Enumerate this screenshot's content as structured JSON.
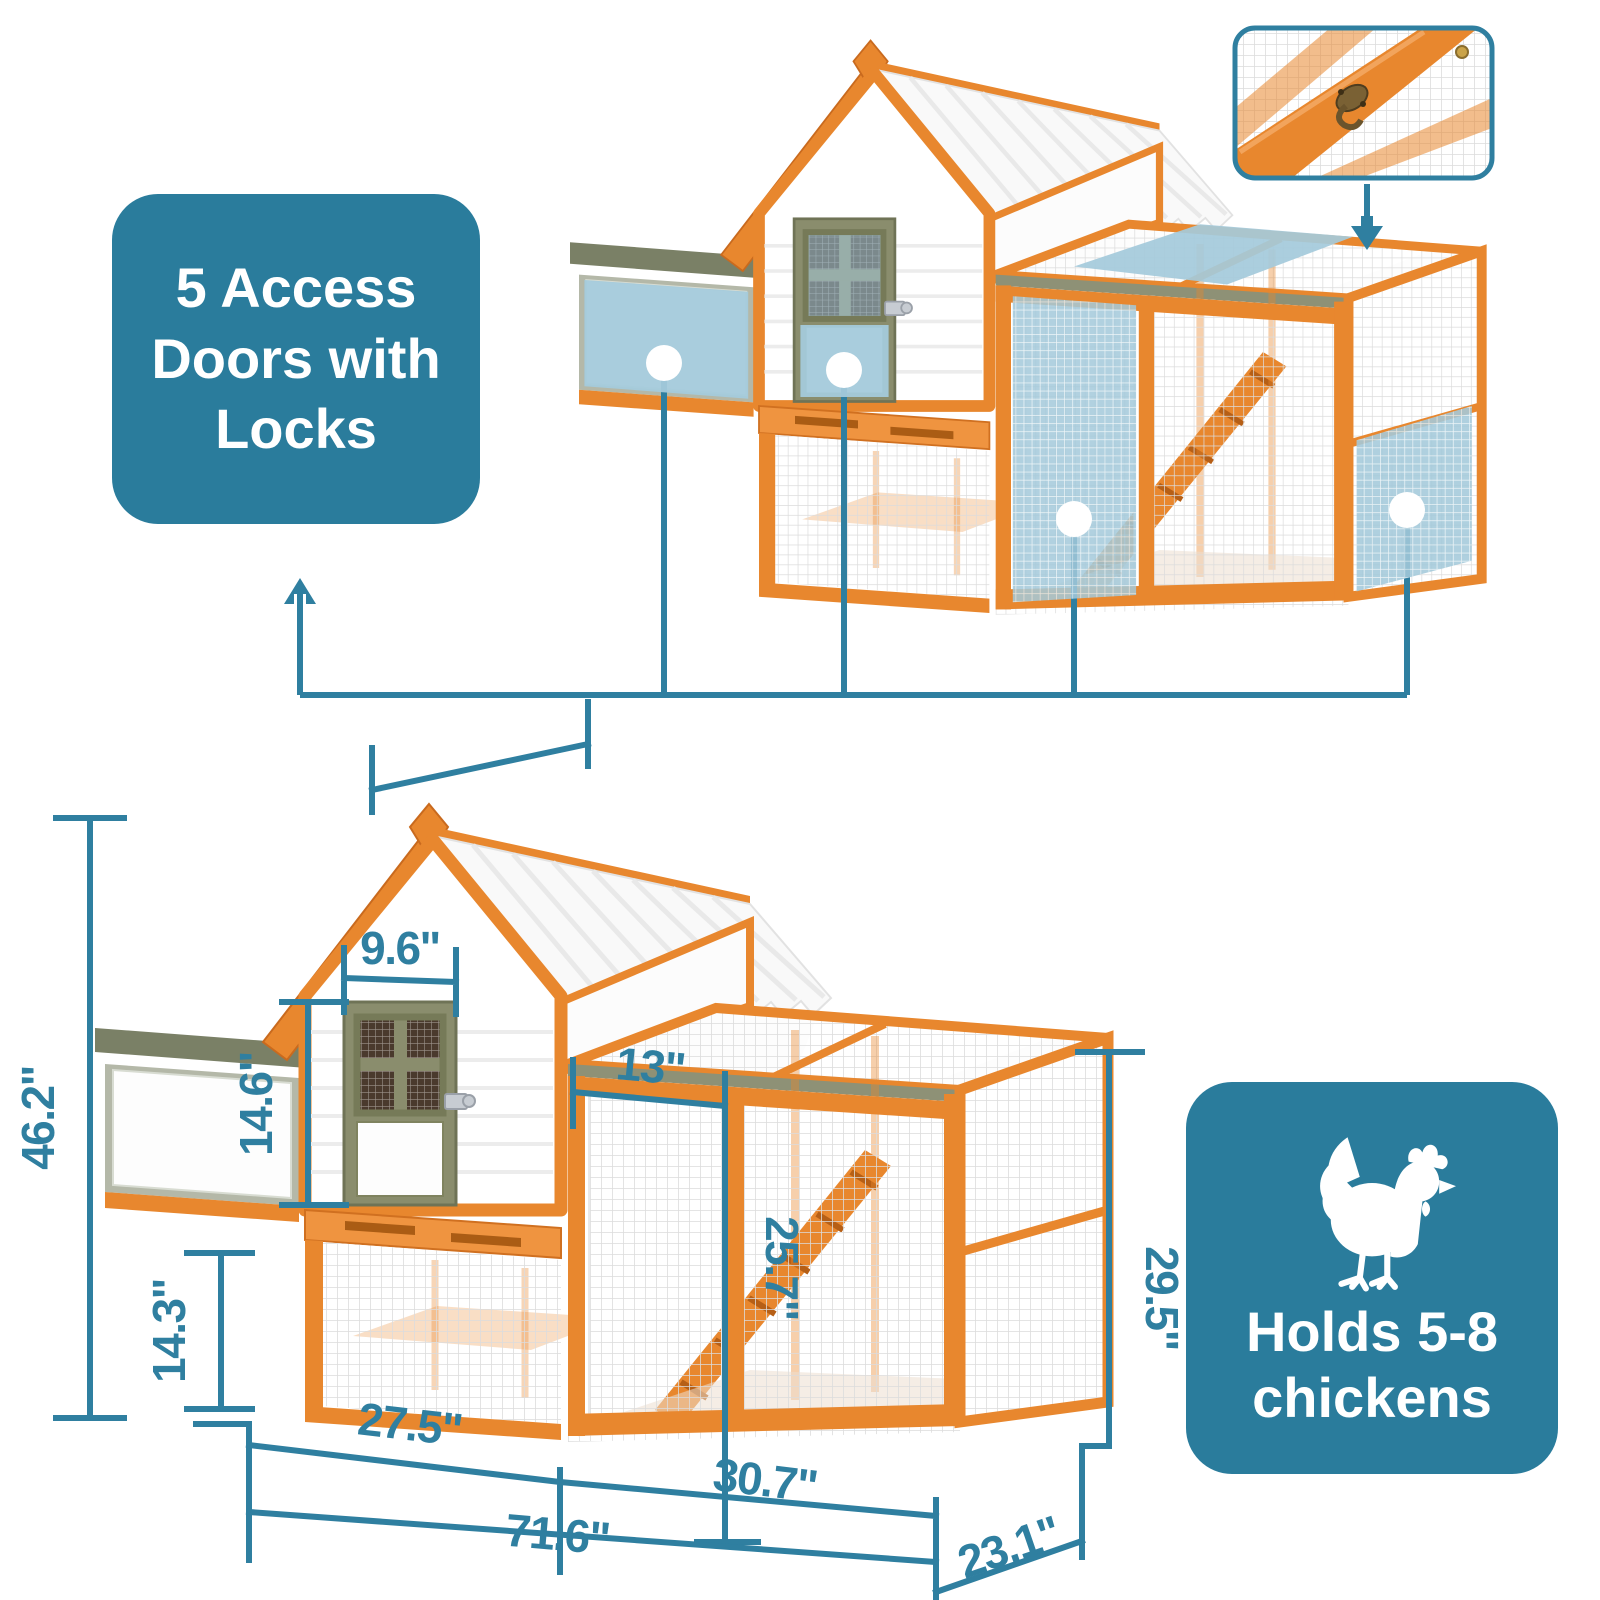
{
  "colors": {
    "teal": "#2a7c9c",
    "dimline": "#2f7fa0",
    "highlight": "#a4cadb",
    "wood": "#e8872e",
    "wooddark": "#c96a1e",
    "woodlight": "#ef9440",
    "olive": "#8a8d6d",
    "nestroof": "#7a8066",
    "runtrim": "#8e9176"
  },
  "callouts": {
    "access_doors": {
      "label": "5 Access Doors with Locks"
    },
    "capacity": {
      "label": "Holds 5-8 chickens",
      "icon": "chicken-icon"
    }
  },
  "inset": {
    "icon": "lock-latch-closeup"
  },
  "dimensions": {
    "labels": [
      {
        "id": "total-height",
        "value": "46.2\""
      },
      {
        "id": "house-door-width",
        "value": "9.6\""
      },
      {
        "id": "house-door-height",
        "value": "14.6\""
      },
      {
        "id": "base-height",
        "value": "14.3\""
      },
      {
        "id": "run-door-width",
        "value": "13\""
      },
      {
        "id": "run-door-height",
        "value": "25.7\""
      },
      {
        "id": "run-height",
        "value": "29.5\""
      },
      {
        "id": "left-section-width",
        "value": "27.5\""
      },
      {
        "id": "run-section-width",
        "value": "30.7\""
      },
      {
        "id": "total-width",
        "value": "71.6\""
      },
      {
        "id": "depth",
        "value": "23.1\""
      }
    ]
  }
}
